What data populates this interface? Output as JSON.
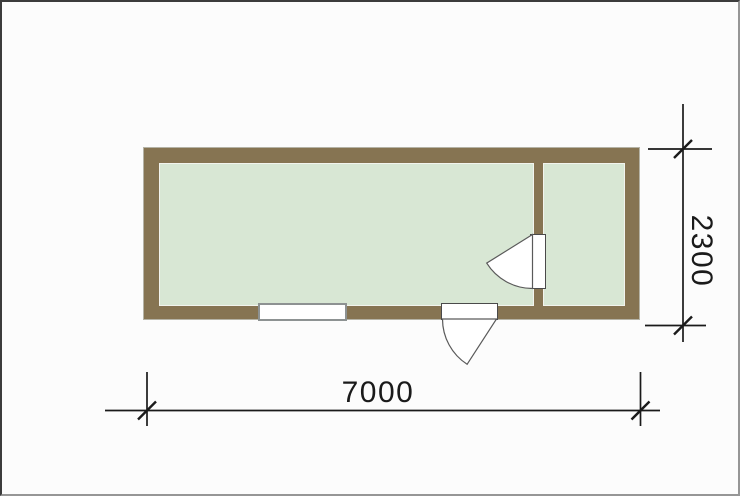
{
  "drawing": {
    "type": "floor-plan",
    "dimensions": {
      "width_label": "7000",
      "height_label": "2300"
    },
    "colors": {
      "wall": "#867452",
      "floor": "#d8e7d4",
      "line": "#1a1a1a",
      "opening_fill": "#ffffff",
      "canvas_background": "#fcfcfc"
    }
  }
}
